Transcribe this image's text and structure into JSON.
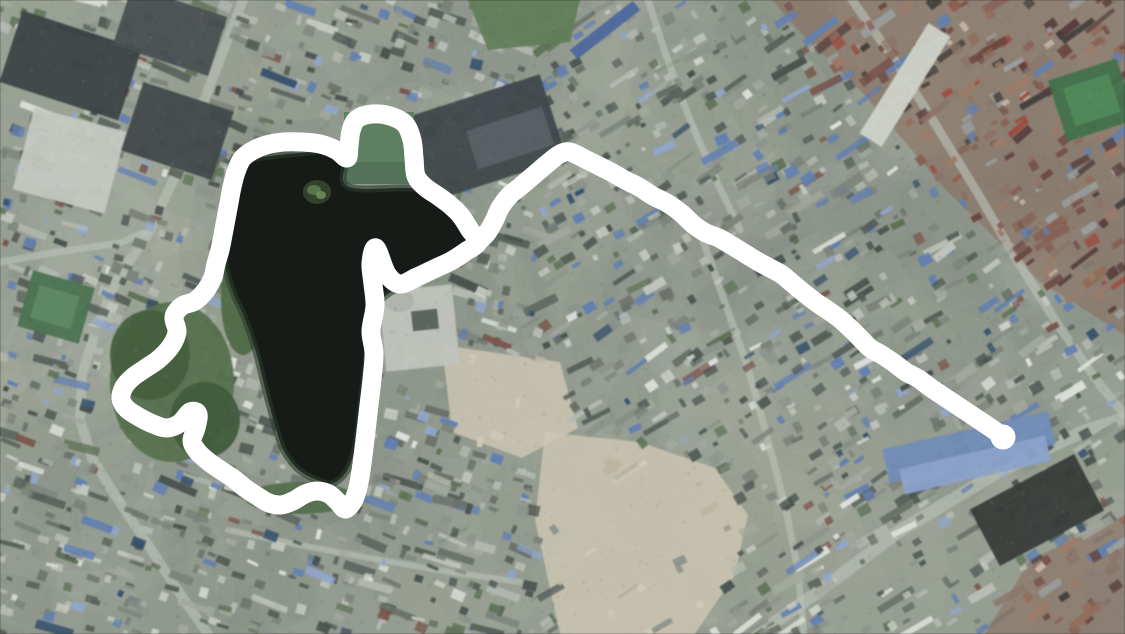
{
  "meta": {
    "view": "satellite-aerial-city",
    "description": "Satellite view of a dense city with a dark lake; a thick white hand-drawn annotation loops around the lake and a white route line extends east across the rooftops",
    "width": 1125,
    "height": 634
  },
  "colors": {
    "annotation_white": "#ffffff",
    "water": "#161b18",
    "water_shore": "#2c3a2b",
    "base_ground": "#949b90",
    "road": "#bcc1b7",
    "island_base": "#33422f",
    "island_light": "#5c7a4e",
    "island_bright": "#74955f",
    "notch_green": "#5d8061",
    "notch_green_dark": "#4e6e52"
  },
  "annotation": {
    "stroke_width": 19,
    "end_dot_radius": 12.5,
    "end_point": [
      1003,
      437
    ],
    "lake_loop": [
      [
        478,
        242
      ],
      [
        470,
        230
      ],
      [
        461,
        216
      ],
      [
        450,
        205
      ],
      [
        438,
        196
      ],
      [
        425,
        187
      ],
      [
        416,
        176
      ],
      [
        414,
        158
      ],
      [
        412,
        140
      ],
      [
        405,
        124
      ],
      [
        390,
        116
      ],
      [
        372,
        114
      ],
      [
        357,
        119
      ],
      [
        351,
        131
      ],
      [
        349,
        146
      ],
      [
        347,
        158
      ],
      [
        336,
        150
      ],
      [
        320,
        144
      ],
      [
        302,
        142
      ],
      [
        284,
        142
      ],
      [
        266,
        145
      ],
      [
        252,
        151
      ],
      [
        242,
        159
      ],
      [
        236,
        172
      ],
      [
        232,
        187
      ],
      [
        229,
        203
      ],
      [
        226,
        219
      ],
      [
        223,
        235
      ],
      [
        220,
        250
      ],
      [
        216,
        264
      ],
      [
        213,
        277
      ],
      [
        206,
        290
      ],
      [
        195,
        301
      ],
      [
        182,
        306
      ],
      [
        174,
        317
      ],
      [
        177,
        332
      ],
      [
        171,
        346
      ],
      [
        159,
        359
      ],
      [
        146,
        368
      ],
      [
        133,
        377
      ],
      [
        124,
        387
      ],
      [
        121,
        399
      ],
      [
        127,
        409
      ],
      [
        139,
        417
      ],
      [
        153,
        424
      ],
      [
        167,
        428
      ],
      [
        180,
        423
      ],
      [
        190,
        412
      ],
      [
        198,
        414
      ],
      [
        196,
        428
      ],
      [
        192,
        441
      ],
      [
        198,
        452
      ],
      [
        209,
        462
      ],
      [
        222,
        471
      ],
      [
        234,
        479
      ],
      [
        245,
        488
      ],
      [
        257,
        496
      ],
      [
        269,
        503
      ],
      [
        281,
        505
      ],
      [
        293,
        501
      ],
      [
        305,
        494
      ],
      [
        317,
        491
      ],
      [
        329,
        494
      ],
      [
        338,
        502
      ],
      [
        345,
        509
      ],
      [
        352,
        503
      ],
      [
        357,
        491
      ],
      [
        360,
        477
      ],
      [
        363,
        456
      ],
      [
        366,
        431
      ],
      [
        369,
        405
      ],
      [
        372,
        379
      ],
      [
        374,
        353
      ],
      [
        371,
        331
      ],
      [
        375,
        306
      ],
      [
        373,
        284
      ],
      [
        371,
        263
      ],
      [
        376,
        248
      ],
      [
        387,
        274
      ],
      [
        400,
        284
      ],
      [
        417,
        277
      ],
      [
        434,
        269
      ],
      [
        451,
        261
      ],
      [
        465,
        252
      ]
    ],
    "route_line": [
      [
        478,
        242
      ],
      [
        487,
        233
      ],
      [
        494,
        221
      ],
      [
        500,
        208
      ],
      [
        509,
        196
      ],
      [
        521,
        186
      ],
      [
        534,
        175
      ],
      [
        548,
        163
      ],
      [
        560,
        154
      ],
      [
        570,
        152
      ],
      [
        583,
        158
      ],
      [
        597,
        165
      ],
      [
        611,
        172
      ],
      [
        625,
        180
      ],
      [
        639,
        187
      ],
      [
        653,
        196
      ],
      [
        667,
        203
      ],
      [
        681,
        213
      ],
      [
        694,
        225
      ],
      [
        706,
        233
      ],
      [
        719,
        238
      ],
      [
        731,
        245
      ],
      [
        744,
        253
      ],
      [
        757,
        261
      ],
      [
        770,
        268
      ],
      [
        781,
        274
      ],
      [
        792,
        283
      ],
      [
        804,
        293
      ],
      [
        817,
        303
      ],
      [
        829,
        311
      ],
      [
        840,
        319
      ],
      [
        851,
        329
      ],
      [
        861,
        339
      ],
      [
        870,
        348
      ],
      [
        882,
        355
      ],
      [
        894,
        363
      ],
      [
        906,
        372
      ],
      [
        919,
        379
      ],
      [
        931,
        388
      ],
      [
        943,
        396
      ],
      [
        955,
        404
      ],
      [
        967,
        412
      ],
      [
        979,
        420
      ],
      [
        991,
        428
      ],
      [
        1001,
        435
      ]
    ]
  },
  "lake": {
    "water_polygon": [
      [
        256,
        158
      ],
      [
        300,
        153
      ],
      [
        344,
        152
      ],
      [
        347,
        186
      ],
      [
        408,
        188
      ],
      [
        436,
        192
      ],
      [
        456,
        205
      ],
      [
        467,
        224
      ],
      [
        469,
        244
      ],
      [
        460,
        257
      ],
      [
        442,
        267
      ],
      [
        420,
        277
      ],
      [
        400,
        287
      ],
      [
        383,
        298
      ],
      [
        375,
        313
      ],
      [
        369,
        340
      ],
      [
        365,
        372
      ],
      [
        361,
        405
      ],
      [
        357,
        437
      ],
      [
        351,
        462
      ],
      [
        342,
        477
      ],
      [
        330,
        484
      ],
      [
        317,
        480
      ],
      [
        303,
        473
      ],
      [
        293,
        464
      ],
      [
        283,
        449
      ],
      [
        276,
        429
      ],
      [
        270,
        407
      ],
      [
        264,
        384
      ],
      [
        258,
        359
      ],
      [
        251,
        336
      ],
      [
        243,
        314
      ],
      [
        235,
        297
      ],
      [
        228,
        277
      ],
      [
        224,
        257
      ],
      [
        224,
        237
      ],
      [
        226,
        214
      ],
      [
        230,
        191
      ],
      [
        238,
        171
      ],
      [
        248,
        160
      ]
    ],
    "island": {
      "cx": 317,
      "cy": 192,
      "rx": 14,
      "ry": 12
    },
    "green_notch": {
      "x": 344,
      "y": 112,
      "w": 70,
      "h": 72
    }
  },
  "districts": [
    {
      "name": "old-town-red-roofs",
      "palette": "red",
      "polygon": [
        [
          772,
          0
        ],
        [
          1125,
          0
        ],
        [
          1125,
          335
        ],
        [
          1040,
          282
        ],
        [
          948,
          192
        ],
        [
          862,
          92
        ],
        [
          800,
          32
        ]
      ]
    },
    {
      "name": "se-brown-roofs",
      "palette": "red",
      "polygon": [
        [
          1030,
          560
        ],
        [
          1125,
          515
        ],
        [
          1125,
          634
        ],
        [
          985,
          634
        ]
      ]
    },
    {
      "name": "cleared-dirt-south",
      "palette": "dirt",
      "polygon": [
        [
          545,
          432
        ],
        [
          640,
          442
        ],
        [
          715,
          468
        ],
        [
          748,
          515
        ],
        [
          735,
          575
        ],
        [
          695,
          634
        ],
        [
          560,
          634
        ],
        [
          535,
          520
        ]
      ]
    },
    {
      "name": "cleared-dirt-mid",
      "palette": "dirt",
      "polygon": [
        [
          442,
          345
        ],
        [
          560,
          362
        ],
        [
          578,
          428
        ],
        [
          522,
          458
        ],
        [
          452,
          432
        ]
      ]
    }
  ],
  "roads": [
    {
      "name": "west-avenue",
      "width": 10,
      "points": [
        [
          243,
          0
        ],
        [
          210,
          85
        ],
        [
          178,
          170
        ],
        [
          150,
          230
        ],
        [
          118,
          278
        ],
        [
          97,
          325
        ],
        [
          82,
          375
        ],
        [
          80,
          420
        ],
        [
          92,
          458
        ],
        [
          115,
          495
        ],
        [
          150,
          548
        ],
        [
          183,
          598
        ],
        [
          208,
          634
        ]
      ]
    },
    {
      "name": "west-link",
      "width": 7,
      "points": [
        [
          0,
          262
        ],
        [
          58,
          252
        ],
        [
          120,
          243
        ],
        [
          150,
          230
        ]
      ]
    },
    {
      "name": "north-street",
      "width": 7,
      "points": [
        [
          648,
          0
        ],
        [
          666,
          55
        ],
        [
          690,
          120
        ],
        [
          716,
          180
        ],
        [
          740,
          230
        ]
      ]
    },
    {
      "name": "ne-diagonal",
      "width": 9,
      "points": [
        [
          852,
          0
        ],
        [
          893,
          58
        ],
        [
          934,
          122
        ],
        [
          977,
          192
        ],
        [
          1012,
          252
        ],
        [
          1058,
          325
        ],
        [
          1100,
          385
        ],
        [
          1125,
          415
        ]
      ]
    },
    {
      "name": "se-boulevard",
      "width": 13,
      "points": [
        [
          758,
          634
        ],
        [
          818,
          592
        ],
        [
          898,
          532
        ],
        [
          998,
          472
        ],
        [
          1082,
          432
        ],
        [
          1125,
          418
        ]
      ]
    },
    {
      "name": "mid-south-street",
      "width": 7,
      "points": [
        [
          700,
          232
        ],
        [
          724,
          300
        ],
        [
          748,
          368
        ],
        [
          768,
          440
        ],
        [
          786,
          510
        ],
        [
          798,
          570
        ],
        [
          804,
          634
        ]
      ]
    },
    {
      "name": "lake-south-street",
      "width": 6,
      "points": [
        [
          228,
          530
        ],
        [
          300,
          545
        ],
        [
          380,
          560
        ],
        [
          450,
          572
        ],
        [
          520,
          582
        ]
      ]
    }
  ],
  "landmarks": [
    {
      "name": "west-light-complex",
      "shape": "rect",
      "x": 22,
      "y": 118,
      "w": 95,
      "h": 85,
      "rot": 15,
      "color": "#c4c8c0"
    },
    {
      "name": "northwest-dark-blocks",
      "shape": "rect",
      "x": 8,
      "y": 28,
      "w": 125,
      "h": 75,
      "rot": 18,
      "color": "#3d4345"
    },
    {
      "name": "northwest-dark-blocks-2",
      "shape": "rect",
      "x": 120,
      "y": 0,
      "w": 100,
      "h": 62,
      "rot": 18,
      "color": "#494f51"
    },
    {
      "name": "northwest-dark-blocks-3",
      "shape": "rect",
      "x": 130,
      "y": 95,
      "w": 95,
      "h": 72,
      "rot": 18,
      "color": "#42484a"
    },
    {
      "name": "ne-industrial-sheds",
      "shape": "rect",
      "x": 402,
      "y": 96,
      "w": 155,
      "h": 88,
      "rot": -18,
      "color": "#40474a"
    },
    {
      "name": "ne-industrial-sheds-light",
      "shape": "rect",
      "x": 470,
      "y": 118,
      "w": 80,
      "h": 40,
      "rot": -18,
      "color": "#5a6266"
    },
    {
      "name": "north-blue-strip-roof",
      "shape": "rect",
      "x": 565,
      "y": 24,
      "w": 80,
      "h": 12,
      "rot": -38,
      "color": "#4a68a0"
    },
    {
      "name": "north-grass",
      "shape": "poly",
      "points": [
        [
          468,
          0
        ],
        [
          580,
          0
        ],
        [
          570,
          42
        ],
        [
          488,
          50
        ]
      ],
      "color": "#5f7e57"
    },
    {
      "name": "ne-sports-field",
      "shape": "rect",
      "x": 1056,
      "y": 68,
      "w": 72,
      "h": 64,
      "rot": -18,
      "color": "#3f7349"
    },
    {
      "name": "ne-sports-field-inner",
      "shape": "rect",
      "x": 1068,
      "y": 80,
      "w": 48,
      "h": 40,
      "rot": -18,
      "color": "#4f8a58"
    },
    {
      "name": "old-town-market-strip",
      "shape": "rect",
      "x": 892,
      "y": 20,
      "w": 26,
      "h": 130,
      "rot": 32,
      "color": "#cfd2c8"
    },
    {
      "name": "west-sports-field",
      "shape": "rect",
      "x": 24,
      "y": 278,
      "w": 64,
      "h": 58,
      "rot": 16,
      "color": "#497450"
    },
    {
      "name": "west-sports-field-inner",
      "shape": "rect",
      "x": 34,
      "y": 290,
      "w": 42,
      "h": 34,
      "rot": 16,
      "color": "#5c8a60"
    },
    {
      "name": "lakeside-park",
      "shape": "ellipse",
      "cx": 172,
      "cy": 382,
      "rx": 62,
      "ry": 80,
      "color": "#55724b"
    },
    {
      "name": "park-trees",
      "shape": "ellipse",
      "cx": 150,
      "cy": 355,
      "rx": 40,
      "ry": 45,
      "color": "#43603c"
    },
    {
      "name": "park-trees-2",
      "shape": "ellipse",
      "cx": 205,
      "cy": 420,
      "rx": 35,
      "ry": 38,
      "color": "#3f5c3a"
    },
    {
      "name": "lake-shore-green",
      "shape": "ellipse",
      "cx": 300,
      "cy": 498,
      "rx": 55,
      "ry": 16,
      "color": "#51704a"
    },
    {
      "name": "lake-shore-green-2",
      "shape": "ellipse",
      "cx": 243,
      "cy": 300,
      "rx": 22,
      "ry": 55,
      "color": "#4c6a44"
    },
    {
      "name": "lakeside-stadium",
      "shape": "rect",
      "x": 382,
      "y": 288,
      "w": 74,
      "h": 80,
      "rot": -6,
      "color": "#c0c4bd"
    },
    {
      "name": "lakeside-stadium-dome",
      "shape": "ellipse",
      "cx": 399,
      "cy": 301,
      "rx": 15,
      "ry": 11,
      "color": "#aeb2ac"
    },
    {
      "name": "lakeside-stadium-core",
      "shape": "rect",
      "x": 412,
      "y": 310,
      "w": 26,
      "h": 20,
      "rot": -6,
      "color": "#565d59"
    },
    {
      "name": "se-blue-warehouse",
      "shape": "rect",
      "x": 884,
      "y": 430,
      "w": 170,
      "h": 34,
      "rot": -13,
      "color": "#6e8cbd"
    },
    {
      "name": "se-blue-warehouse-2",
      "shape": "rect",
      "x": 900,
      "y": 452,
      "w": 150,
      "h": 26,
      "rot": -13,
      "color": "#89a3cf"
    },
    {
      "name": "se-dark-towers",
      "shape": "rect",
      "x": 978,
      "y": 478,
      "w": 118,
      "h": 64,
      "rot": -28,
      "color": "#383d39"
    }
  ],
  "palettes": {
    "urban": {
      "base": [
        "#7b8279",
        "#8d948a",
        "#a2a89c",
        "#6a716a",
        "#565f5b",
        "#c3c8be",
        "#b3b9af",
        "#4a524e"
      ],
      "accents": [
        [
          "#5f80b6",
          0.08
        ],
        [
          "#8fa6cf",
          0.04
        ],
        [
          "#7d564c",
          0.03
        ],
        [
          "#5d7355",
          0.07
        ],
        [
          "#dde0da",
          0.06
        ],
        [
          "#32506e",
          0.02
        ]
      ]
    },
    "red": {
      "base": [
        "#8a5f52",
        "#7a5048",
        "#956a58",
        "#6b453e",
        "#a07a66",
        "#5a3f3c",
        "#8c7468",
        "#9aa0a0"
      ],
      "accents": [
        [
          "#5f80b6",
          0.06
        ],
        [
          "#a34a3e",
          0.06
        ],
        [
          "#44403c",
          0.08
        ],
        [
          "#c9b4a4",
          0.06
        ]
      ]
    },
    "dirt": {
      "base": [
        "#c6bda9",
        "#d2cab6",
        "#bdb49e"
      ],
      "accents": [
        [
          "#8d948a",
          0.2
        ]
      ],
      "sparse": 0.75
    }
  }
}
